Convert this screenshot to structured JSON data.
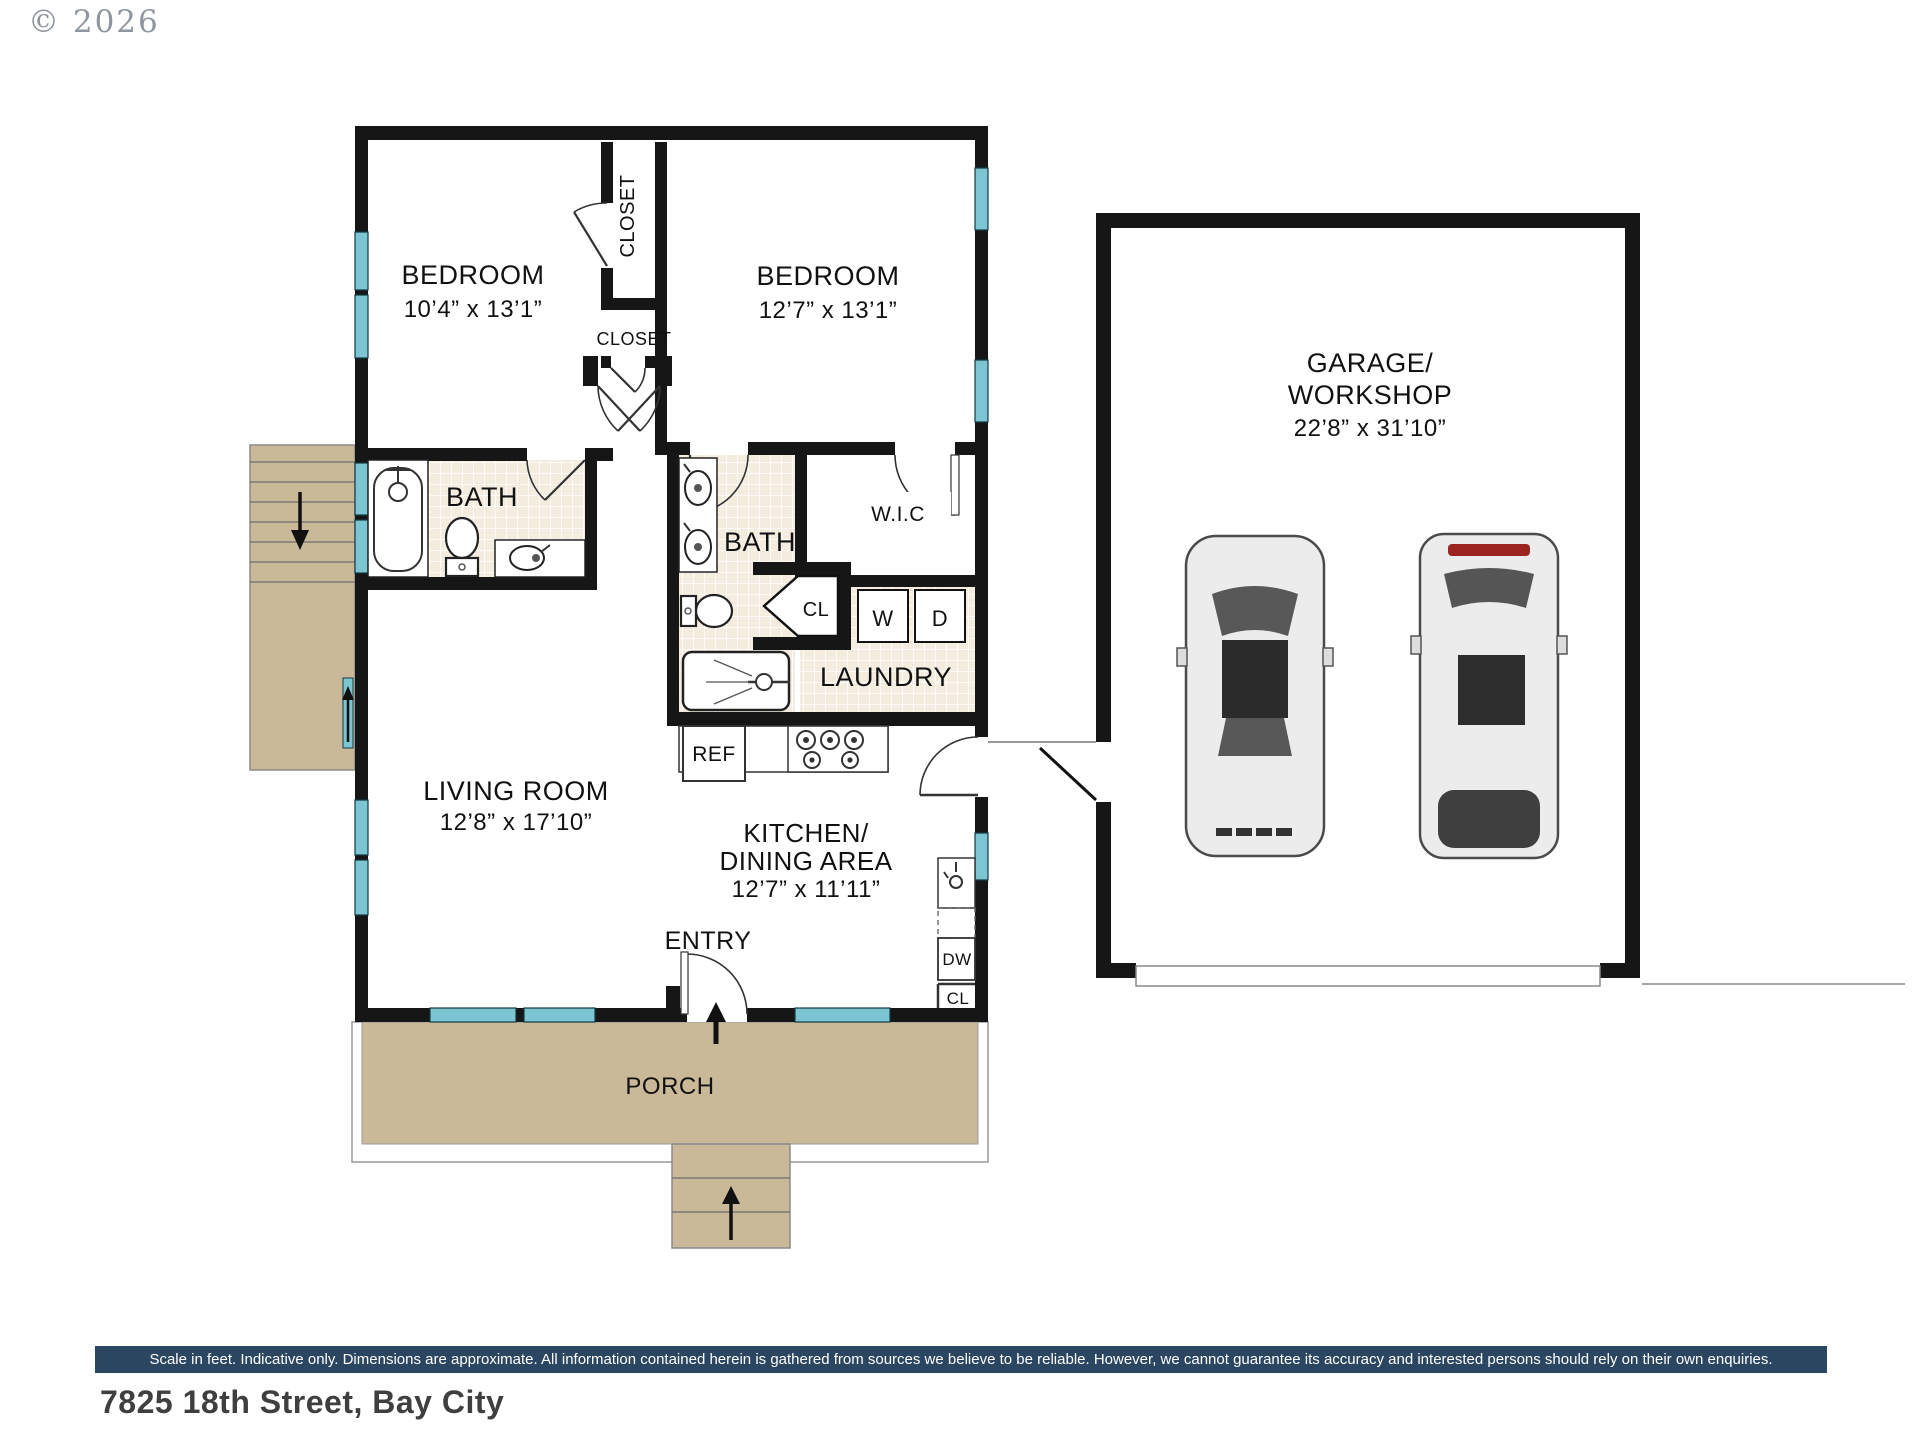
{
  "header": {
    "copyright": "© 2026"
  },
  "labels": {
    "bedroom1_name": "BEDROOM",
    "bedroom1_dims": "10’4” x 13’1”",
    "bedroom2_name": "BEDROOM",
    "bedroom2_dims": "12’7” x 13’1”",
    "closet_upper": "CLOSET",
    "closet_lower": "CLOSET",
    "bath_left": "BATH",
    "bath_main": "BATH",
    "wic": "W.I.C",
    "hall_closet": "CL",
    "washer": "W",
    "dryer": "D",
    "laundry": "LAUNDRY",
    "fridge": "REF",
    "living_name": "LIVING ROOM",
    "living_dims": "12’8” x 17’10”",
    "kitchen_line1": "KITCHEN/",
    "kitchen_line2": "DINING AREA",
    "kitchen_dims": "12’7” x 11’11”",
    "entry": "ENTRY",
    "dishwasher": "DW",
    "kitchen_closet": "CL",
    "porch": "PORCH",
    "garage_line1": "GARAGE/",
    "garage_line2": "WORKSHOP",
    "garage_dims": "22’8” x 31’10”"
  },
  "footer": {
    "disclaimer": "Scale in feet. Indicative only. Dimensions are approximate. All information contained herein is gathered from sources we believe to be reliable. However, we cannot guarantee its accuracy and interested persons should rely on their own enquiries.",
    "address": "7825 18th Street, Bay City"
  },
  "colors": {
    "wall": "#161616",
    "window": "#7cc5d2",
    "deck": "#c9b998",
    "tile": "#f4ecdf",
    "footer_bar": "#2b4660",
    "tail_light": "#9b2420"
  }
}
